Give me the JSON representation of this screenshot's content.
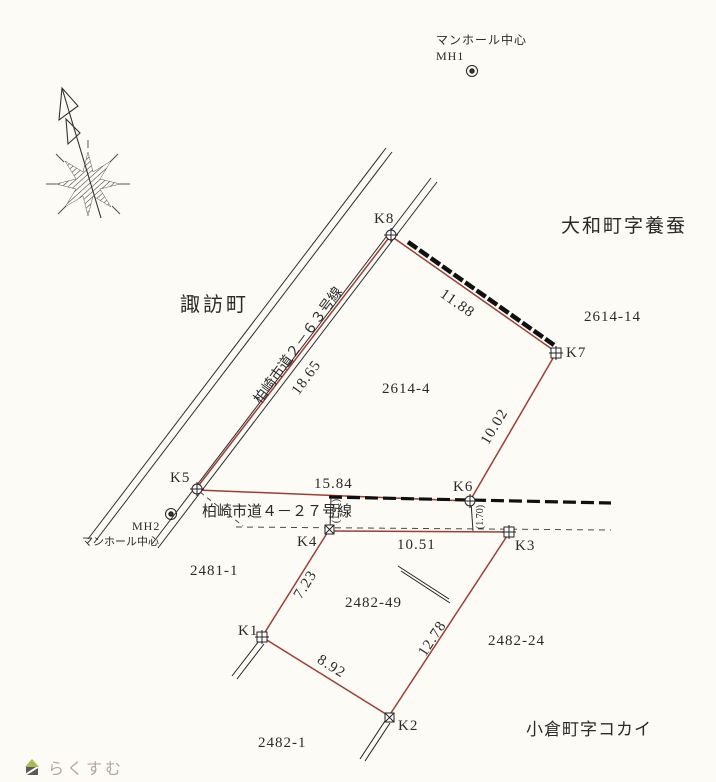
{
  "map": {
    "manhole1": {
      "caption": "マンホール中心",
      "label": "MH1"
    },
    "manhole2": {
      "label": "MH2",
      "caption": "マンホール中心"
    },
    "districts": {
      "suwa": "諏訪町",
      "yamato": "大和町字養蚕",
      "ogura": "小倉町字コカイ"
    },
    "roads": {
      "r263": "柏崎市道２－６３号線",
      "r427": "柏崎市道４－２７号線"
    },
    "parcels": {
      "p2614_4": "2614-4",
      "p2614_14": "2614-14",
      "p2481_1": "2481-1",
      "p2482_49": "2482-49",
      "p2482_24": "2482-24",
      "p2482_1": "2482-1"
    },
    "points": {
      "k1": "K1",
      "k2": "K2",
      "k3": "K3",
      "k4": "K4",
      "k5": "K5",
      "k6": "K6",
      "k7": "K7",
      "k8": "K8"
    },
    "distances": {
      "k5_k8": "18.65",
      "k8_k7": "11.88",
      "k7_k6": "10.02",
      "k5_k6": "15.84",
      "k4_k3": "10.51",
      "k4_k1": "7.23",
      "k1_k2": "8.92",
      "k2_k3": "12.78",
      "k4_offset": "(1.91)",
      "k6_offset": "(1.70)"
    },
    "colors": {
      "boundary": "#9c3f35",
      "ink": "#2a2a2a"
    }
  },
  "watermark": {
    "label": "らくすむ"
  }
}
